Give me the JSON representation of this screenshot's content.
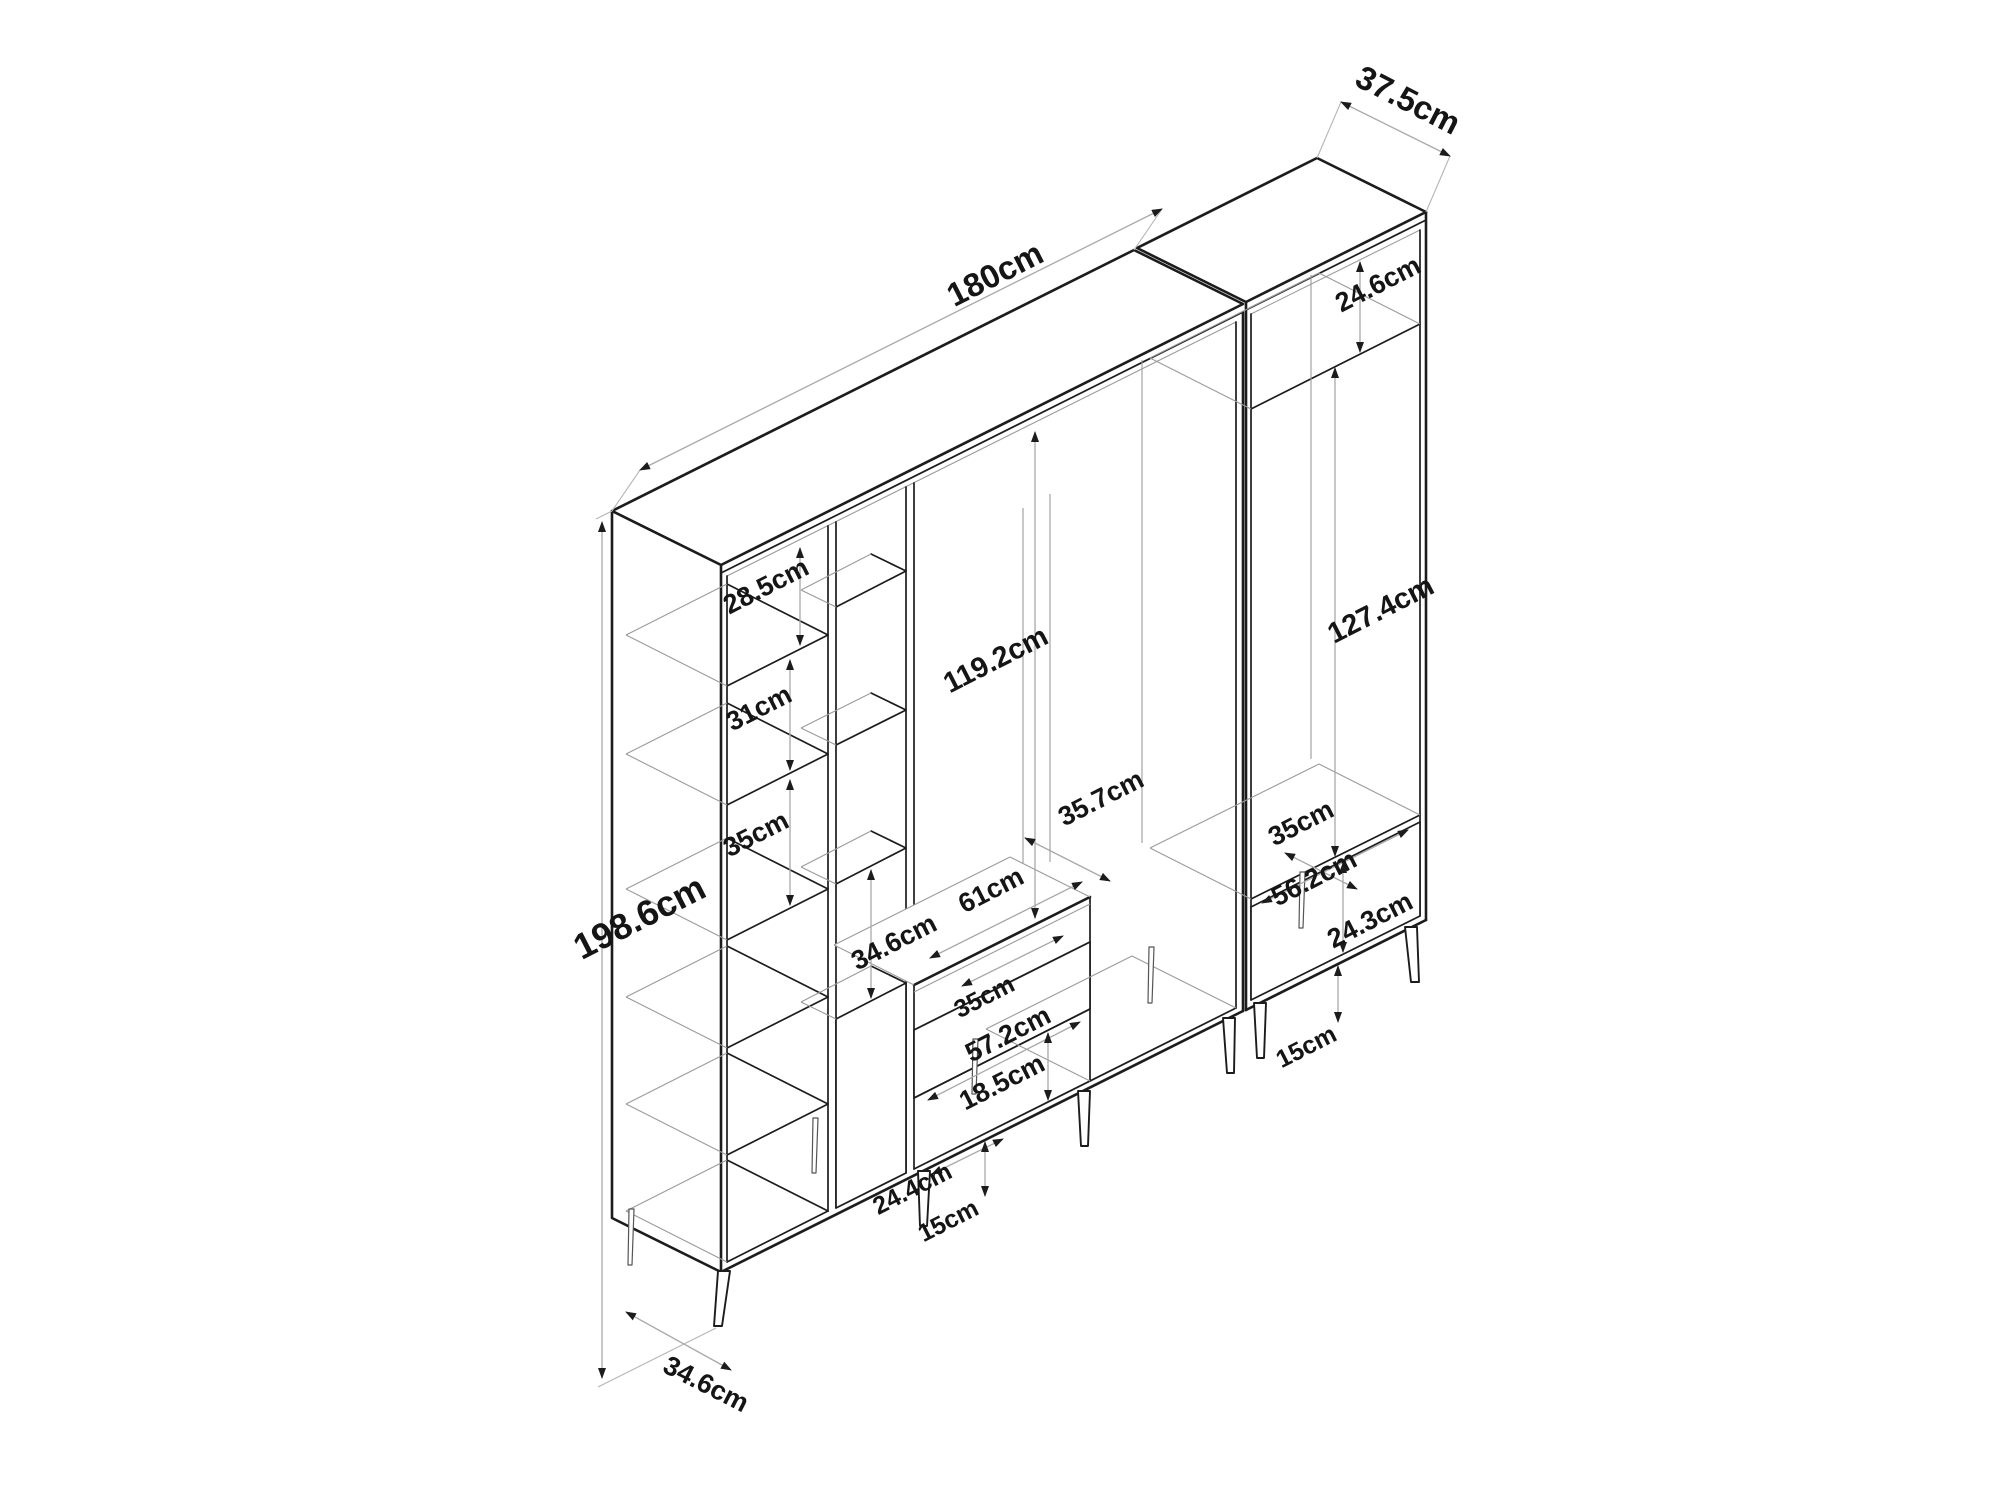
{
  "diagram": {
    "type": "furniture-dimension-drawing",
    "units": "cm",
    "dims": {
      "total_width": "180cm",
      "total_depth": "37.5cm",
      "total_height": "198.6cm",
      "left_shelf_top": "28.5cm",
      "left_shelf_2": "31cm",
      "left_shelf_3": "35cm",
      "mid_column_opening": "34.6cm",
      "center_open_height": "119.2cm",
      "bench_width": "61cm",
      "bench_depth": "35.7cm",
      "drawer_slot_width": "35cm",
      "drawer_width": "57.2cm",
      "drawer_opening_height": "18.5cm",
      "base_segment_width": "24.4cm",
      "left_leg_height": "15cm",
      "floor_depth": "34.6cm",
      "right_top_shelf": "24.6cm",
      "right_open_height": "127.4cm",
      "right_floor_depth": "35cm",
      "right_floor_width": "56.2cm",
      "right_drawer_height": "24.3cm",
      "right_leg_height": "15cm"
    }
  }
}
